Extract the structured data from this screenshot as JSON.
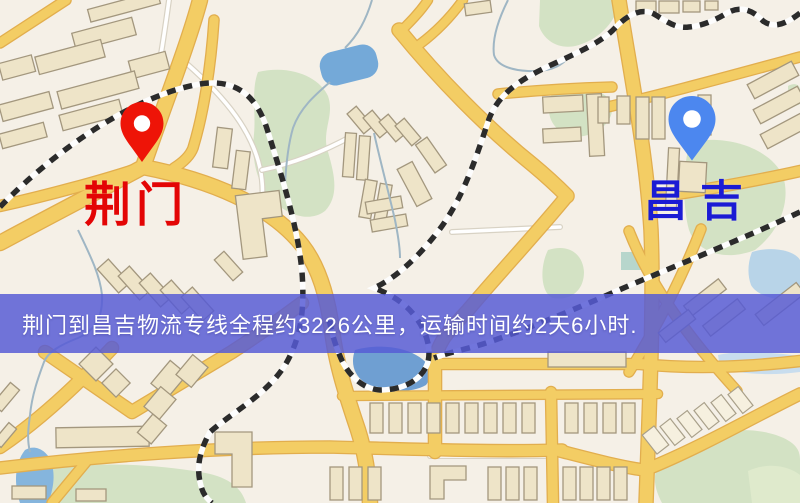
{
  "map": {
    "origin": {
      "name": "荆门",
      "pin_icon": "red-map-pin",
      "pin_color": "#ee1407",
      "label_color": "#e30505"
    },
    "destination": {
      "name": "昌吉",
      "pin_icon": "blue-map-pin",
      "pin_color": "#4c87ef",
      "label_color": "#1b1bd4"
    }
  },
  "banner": {
    "text": "荆门到昌吉物流专线全程约3226公里，运输时间约2天6小时.",
    "bg": "rgba(86,90,213,0.84)",
    "text_color": "#ffffff"
  },
  "theme": {
    "map_bg": "#f5f0e7",
    "road": "#f3cd64",
    "road_casing": "#e2ae4e",
    "water": "#74a9d8",
    "green": "#d3e2c4",
    "building": "#eee4c8",
    "building_stroke": "#a3977e",
    "railway": "#2b2b2b"
  }
}
